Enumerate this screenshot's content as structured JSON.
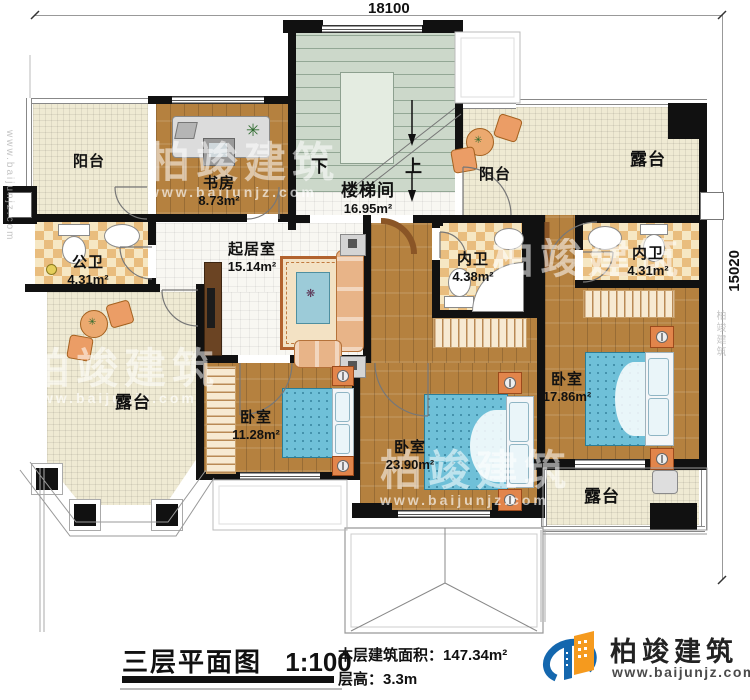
{
  "dimensions": {
    "top": "18100",
    "right": "15020"
  },
  "rooms": {
    "balcony_tl": {
      "label": "阳台"
    },
    "study": {
      "label": "书房",
      "area": "8.73m²"
    },
    "stairwell": {
      "label": "楼梯间",
      "area": "16.95m²",
      "down": "下",
      "up": "上"
    },
    "balcony_tr": {
      "label": "阳台"
    },
    "terrace_tr": {
      "label": "露台"
    },
    "public_bath": {
      "label": "公卫",
      "area": "4.31m²"
    },
    "living": {
      "label": "起居室",
      "area": "15.14m²"
    },
    "bath_master1": {
      "label": "内卫",
      "area": "4.38m²"
    },
    "bath_master2": {
      "label": "内卫",
      "area": "4.31m²"
    },
    "terrace_bl": {
      "label": "露台"
    },
    "bedroom_small": {
      "label": "卧室",
      "area": "11.28m²"
    },
    "bedroom_mid": {
      "label": "卧室",
      "area": "23.90m²"
    },
    "bedroom_right": {
      "label": "卧室",
      "area": "17.86m²"
    },
    "terrace_br": {
      "label": "露台"
    }
  },
  "titleblock": {
    "title": "三层平面图",
    "scale": "1:100",
    "area_label": "本层建筑面积：",
    "area_value": "147.34m²",
    "height_label": "层高：",
    "height_value": "3.3m"
  },
  "brand": {
    "name": "柏竣建筑",
    "url": "www.baijunjz.com"
  },
  "watermark": {
    "name": "柏竣建筑",
    "url": "www.baijunjz.com"
  },
  "colors": {
    "wall": "#111111",
    "wood": "#b5813f",
    "checker": "#e9bd7e",
    "cream": "#efead3",
    "tile": "#f8f7f2",
    "stair": "#ccd8ca",
    "bed": "#6fc0d8",
    "accent_orange": "#e2854b",
    "brand_blue": "#1467ae",
    "brand_orange": "#f59a1e"
  }
}
